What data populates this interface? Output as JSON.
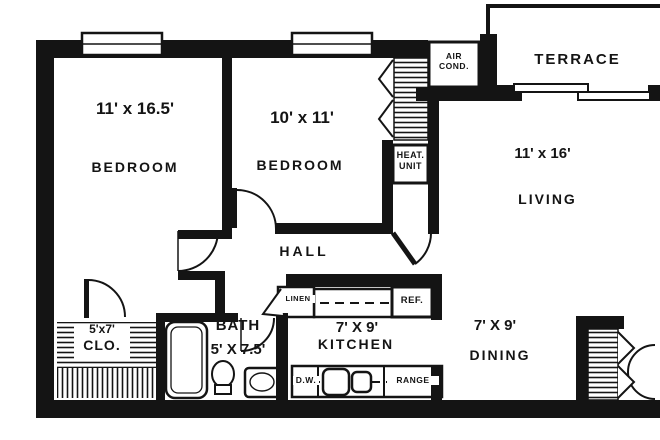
{
  "colors": {
    "ink": "#141414",
    "paper": "#ffffff"
  },
  "rooms": {
    "bedroom_1": {
      "dims": "11' x 16.5'",
      "label": "BEDROOM"
    },
    "bedroom_2": {
      "dims": "10' x 11'",
      "label": "BEDROOM"
    },
    "living": {
      "dims": "11' x 16'",
      "label": "LIVING"
    },
    "terrace": {
      "label": "TERRACE"
    },
    "hall": {
      "label": "HALL"
    },
    "bath": {
      "dims": "5' X 7.5'",
      "label": "BATH"
    },
    "kitchen": {
      "dims": "7' X 9'",
      "label": "KITCHEN"
    },
    "dining": {
      "dims": "7' X 9'",
      "label": "DINING"
    },
    "closet": {
      "dims": "5'x7'",
      "label": "CLO."
    }
  },
  "fixtures": {
    "air_conditioner": {
      "line1": "AIR",
      "line2": "COND."
    },
    "heat_unit": {
      "line1": "HEAT.",
      "line2": "UNIT"
    },
    "linen_closet": {
      "label": "LINEN"
    },
    "refrigerator": {
      "label": "REF."
    },
    "dishwasher": {
      "label": "D.W."
    },
    "range": {
      "label": "RANGE"
    }
  }
}
